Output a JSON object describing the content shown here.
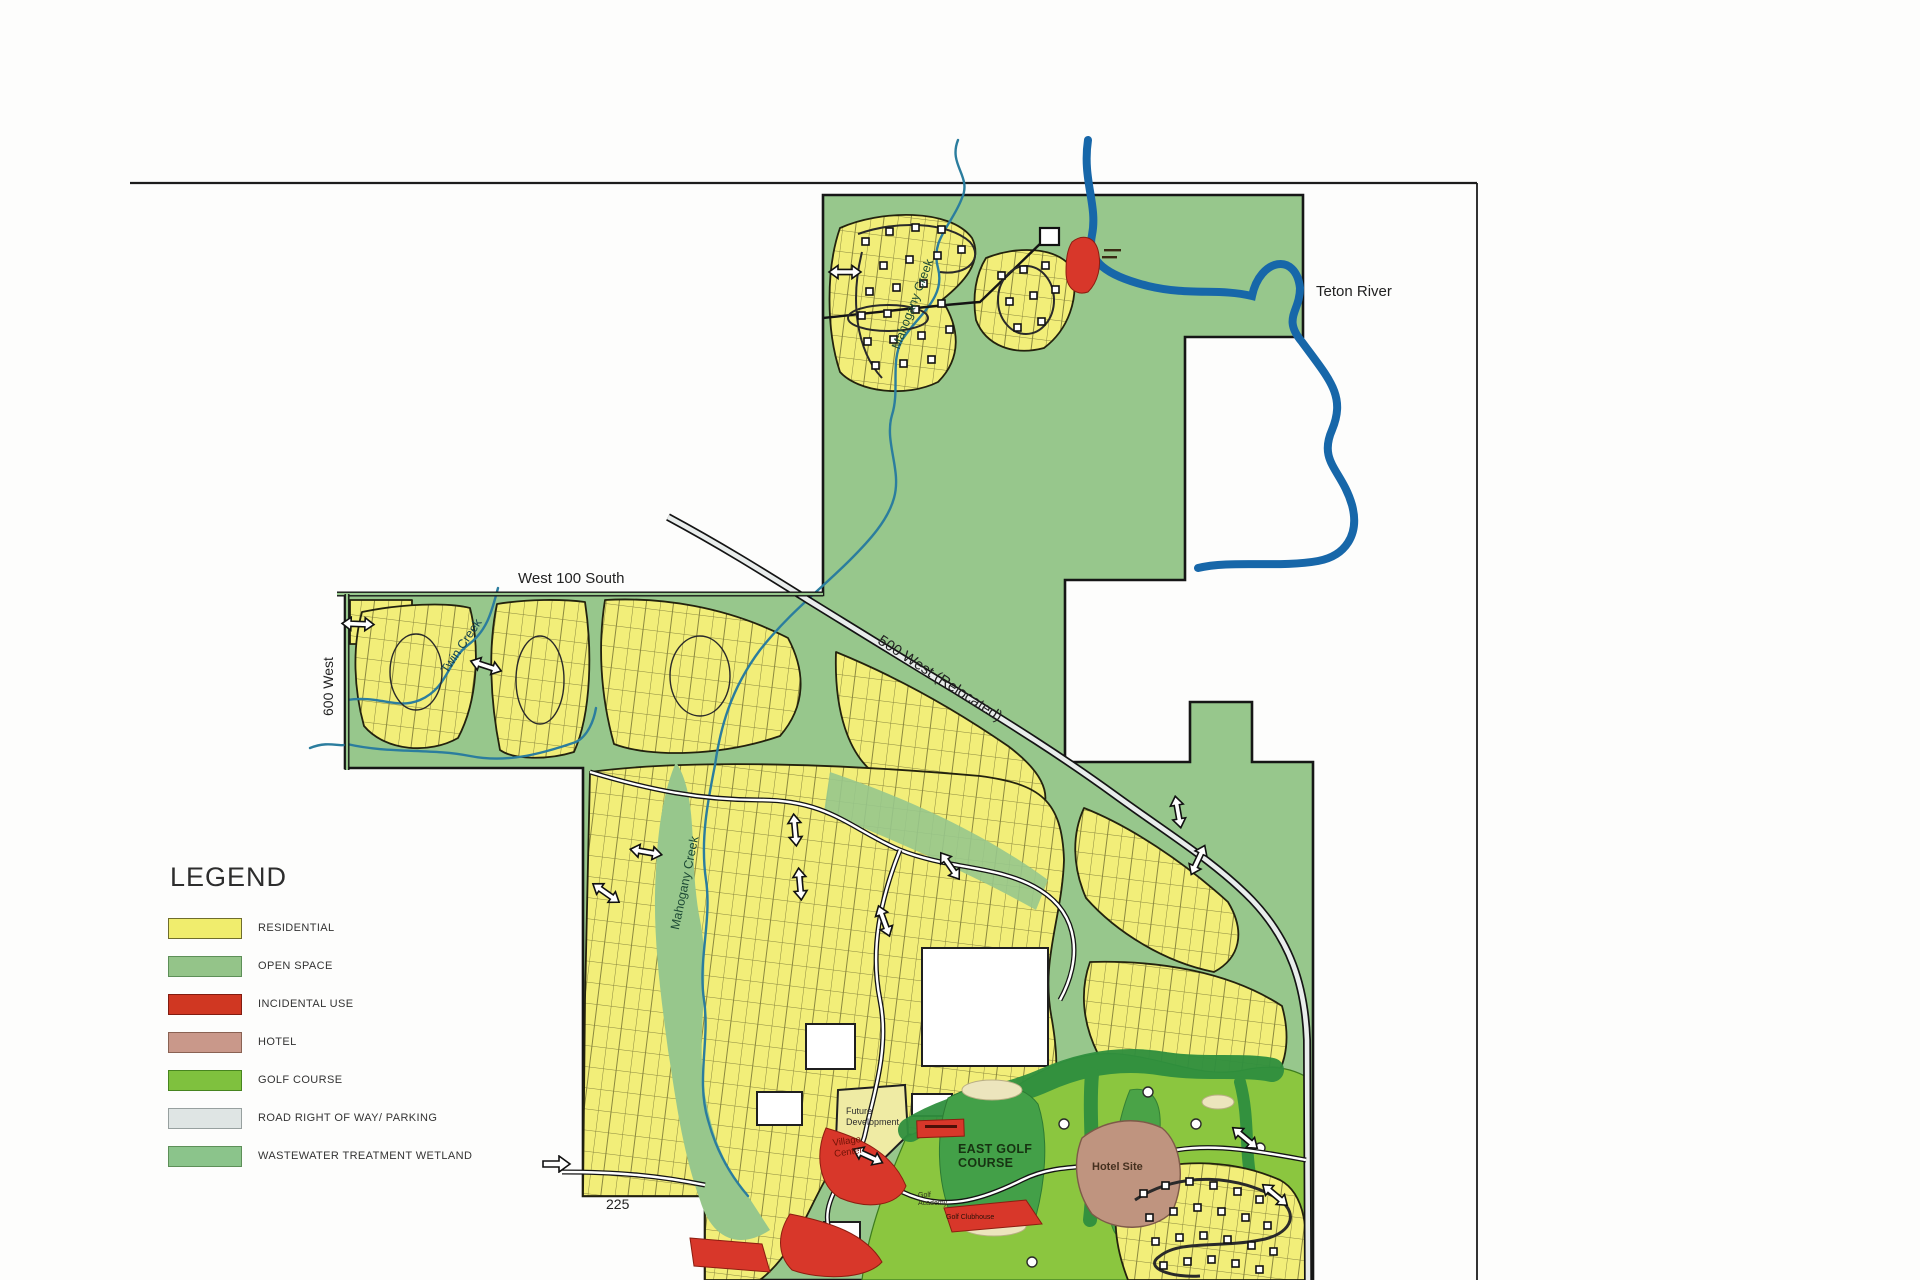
{
  "page": {
    "background": "#fdfdfc"
  },
  "legend": {
    "title": "LEGEND",
    "items": [
      {
        "label": "RESIDENTIAL",
        "color": "#f0ed6d",
        "border": "#6f6d2c"
      },
      {
        "label": "OPEN SPACE",
        "color": "#94c489",
        "border": "#5d8f58"
      },
      {
        "label": "INCIDENTAL USE",
        "color": "#d03722",
        "border": "#821c10"
      },
      {
        "label": "HOTEL",
        "color": "#c9988a",
        "border": "#8a6253"
      },
      {
        "label": "GOLF COURSE",
        "color": "#7fc13e",
        "border": "#47851f"
      },
      {
        "label": "ROAD RIGHT OF WAY/ PARKING",
        "color": "#dfe5e4",
        "border": "#97a09f"
      },
      {
        "label": "WASTEWATER TREATMENT WETLAND",
        "color": "#8bc48b",
        "border": "#5d8f58"
      }
    ]
  },
  "map": {
    "labels": {
      "teton_river": "Teton River",
      "west_100_south": "West 100 South",
      "west_600": "600 West",
      "twin_creek": "Twin Creek",
      "mahogany_creek_upper": "Mahogany Creek",
      "mahogany_creek_lower": "Mahogany Creek",
      "west_500_relocated": "500 West (Relocated)",
      "route_225": "225",
      "future_development": "Future Development",
      "village_center": "Village Center",
      "east_golf_course": "EAST GOLF COURSE",
      "golf_academy": "Golf Academy",
      "golf_clubhouse": "Golf Clubhouse",
      "hotel_site": "Hotel Site"
    },
    "colors": {
      "open_space": "#97c78c",
      "residential": "#f2ee79",
      "incidental": "#d8372a",
      "hotel": "#bf947f",
      "golf": "#8bc63f",
      "fairway": "#43a048",
      "tree": "#2f8f3e",
      "sand": "#ece5bd",
      "road": "#e9edec",
      "river": "#1767a9",
      "creek": "#2b7d9e",
      "boundary": "#161616"
    }
  }
}
